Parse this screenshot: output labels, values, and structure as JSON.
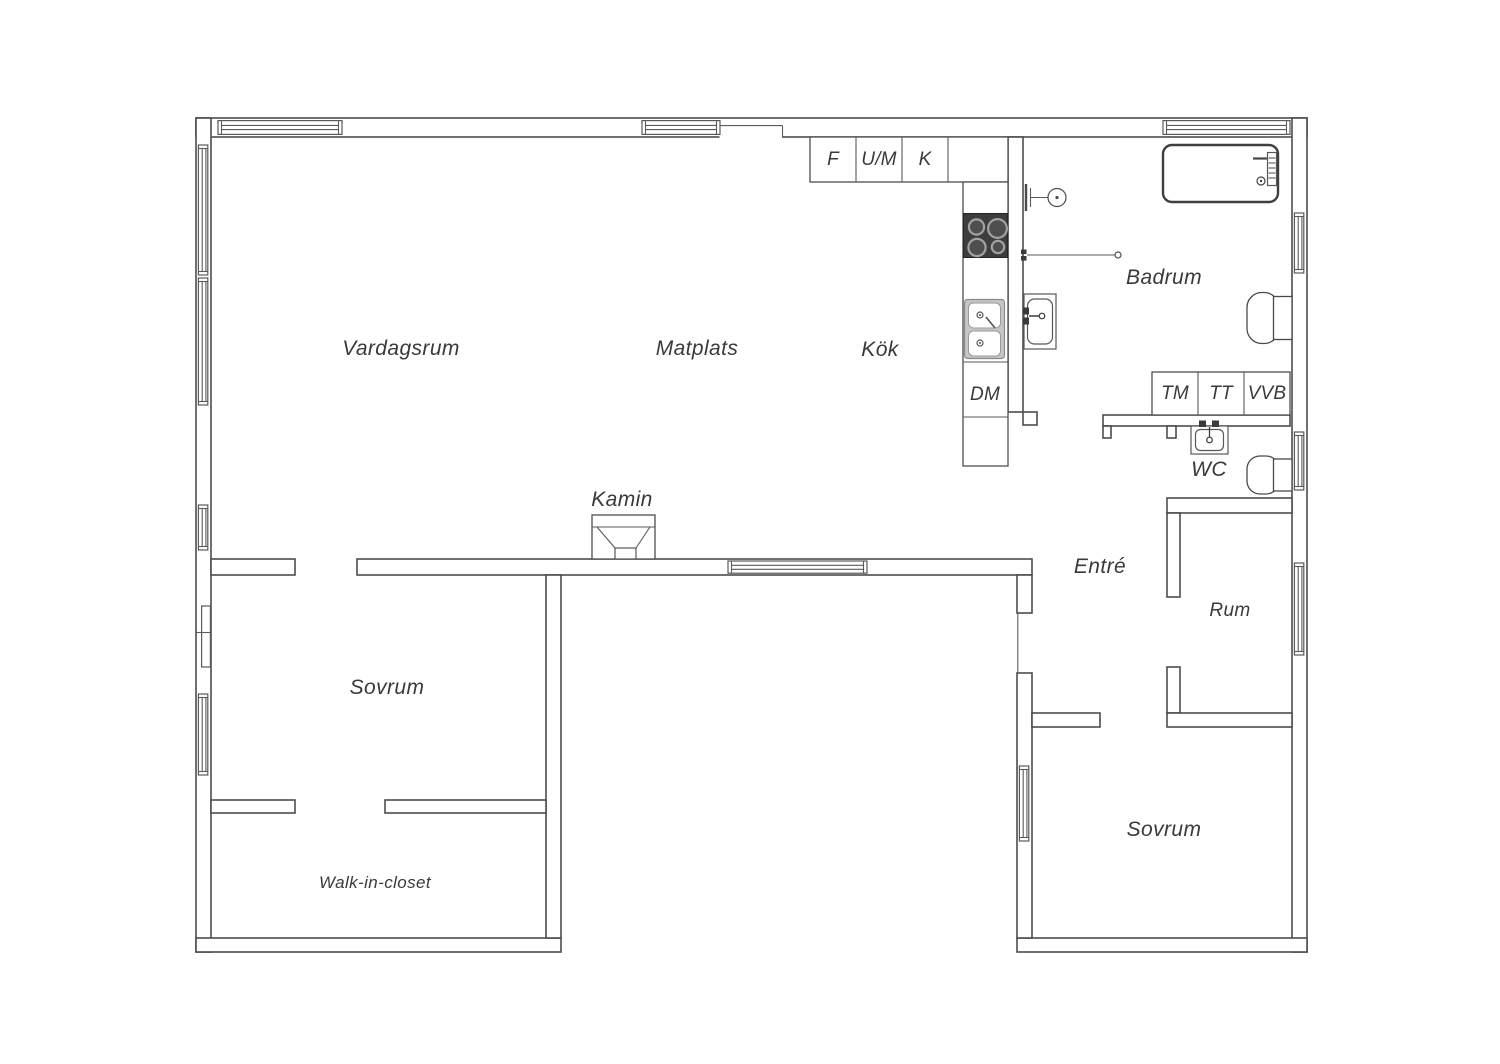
{
  "floorplan": {
    "colors": {
      "background": "#ffffff",
      "lines": "#4d4d4d",
      "text": "#3a3a3a",
      "stove": "#3d3d3d",
      "sink_counter": "#c6c6c6"
    },
    "rooms": {
      "vardagsrum": "Vardagsrum",
      "matplats": "Matplats",
      "kok": "Kök",
      "badrum": "Badrum",
      "wc": "WC",
      "entre": "Entré",
      "rum": "Rum",
      "sovrum_left": "Sovrum",
      "sovrum_right": "Sovrum",
      "walk_in_closet": "Walk-in-closet"
    },
    "features": {
      "kamin": "Kamin"
    },
    "appliances": {
      "f": "F",
      "um": "U/M",
      "k": "K",
      "dm": "DM",
      "tm": "TM",
      "tt": "TT",
      "vvb": "VVB"
    }
  }
}
